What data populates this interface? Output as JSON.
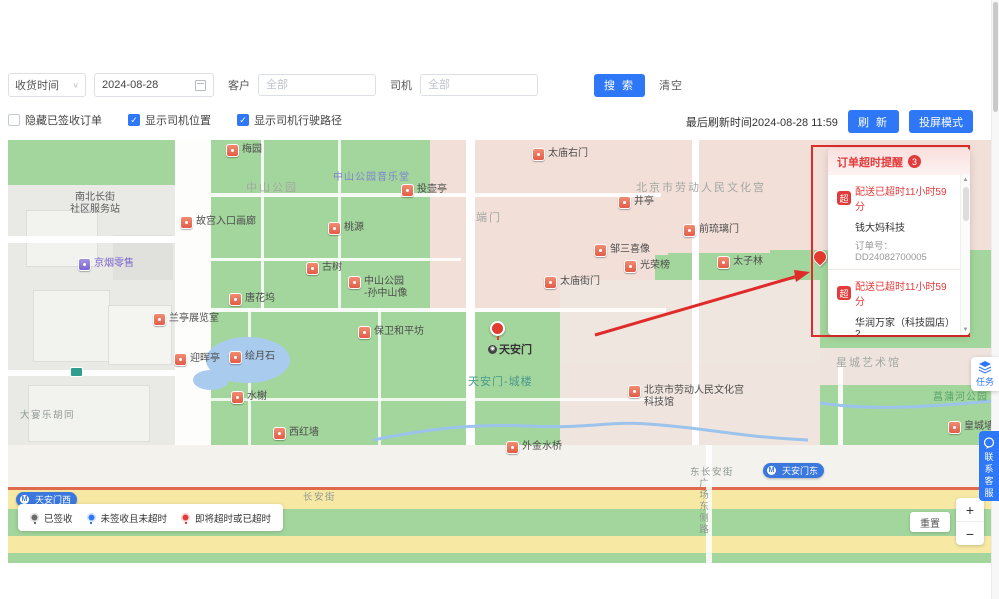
{
  "toolbar": {
    "time_type": "收货时间",
    "date_value": "2024-08-28",
    "customer_label": "客户",
    "customer_placeholder": "全部",
    "driver_label": "司机",
    "driver_placeholder": "全部",
    "search_label": "搜 索",
    "clear_label": "清空"
  },
  "filter_bar": {
    "hide_signed": {
      "label": "隐藏已签收订单",
      "checked": false
    },
    "show_driver_location": {
      "label": "显示司机位置",
      "checked": true
    },
    "show_driver_route": {
      "label": "显示司机行驶路径",
      "checked": true
    },
    "last_refresh": "最后刷新时间2024-08-28 11:59",
    "refresh_label": "刷 新",
    "cast_label": "投屏模式"
  },
  "alert_panel": {
    "title": "订单超时提醒",
    "count": "3",
    "items": [
      {
        "badge": "超",
        "status": "配送已超时11小时59分",
        "customer": "钱大妈科技",
        "order_no": "订单号：DD24082700005"
      },
      {
        "badge": "超",
        "status": "配送已超时11小时59分",
        "customer": "华润万家（科技园店）2",
        "order_no": "订单号：DD24082700003"
      },
      {
        "badge": "超",
        "status": "剩余0分",
        "customer": "华润万家（科技园店）2",
        "order_no": ""
      }
    ]
  },
  "map": {
    "labels": [
      {
        "text": "梅园",
        "x": 218,
        "y": 4,
        "type": "poi"
      },
      {
        "text": "中山公园",
        "x": 238,
        "y": 42,
        "type": "area"
      },
      {
        "lines": [
          "南北长街",
          "社区服务站"
        ],
        "x": 62,
        "y": 52,
        "type": "area-dark"
      },
      {
        "text": "中山公园音乐堂",
        "x": 325,
        "y": 32,
        "type": "area-purple"
      },
      {
        "text": "故宫入口画廊",
        "x": 172,
        "y": 76,
        "type": "poi"
      },
      {
        "text": "桃源",
        "x": 320,
        "y": 82,
        "type": "poi"
      },
      {
        "text": "京烟零售",
        "x": 70,
        "y": 118,
        "type": "poi poi-purple"
      },
      {
        "text": "投壶亭",
        "x": 393,
        "y": 44,
        "type": "poi"
      },
      {
        "text": "端门",
        "x": 468,
        "y": 72,
        "type": "area"
      },
      {
        "text": "太庙右门",
        "x": 524,
        "y": 8,
        "type": "poi"
      },
      {
        "text": "井亭",
        "x": 610,
        "y": 56,
        "type": "poi"
      },
      {
        "text": "北京市劳动人民文化宫",
        "x": 628,
        "y": 42,
        "type": "area"
      },
      {
        "text": "前琉璃门",
        "x": 675,
        "y": 84,
        "type": "poi"
      },
      {
        "text": "邹三喜像",
        "x": 586,
        "y": 104,
        "type": "poi"
      },
      {
        "text": "光荣榜",
        "x": 616,
        "y": 120,
        "type": "poi"
      },
      {
        "text": "太子林",
        "x": 709,
        "y": 116,
        "type": "poi"
      },
      {
        "text": "太庙街门",
        "x": 536,
        "y": 136,
        "type": "poi"
      },
      {
        "text": "古树",
        "x": 298,
        "y": 122,
        "type": "poi"
      },
      {
        "lines": [
          "中山公园",
          "-孙中山像"
        ],
        "x": 340,
        "y": 136,
        "type": "poi"
      },
      {
        "text": "唐花坞",
        "x": 221,
        "y": 153,
        "type": "poi"
      },
      {
        "text": "兰亭展览室",
        "x": 145,
        "y": 173,
        "type": "poi"
      },
      {
        "text": "保卫和平坊",
        "x": 350,
        "y": 186,
        "type": "poi"
      },
      {
        "text": "迎晖亭",
        "x": 166,
        "y": 213,
        "type": "poi"
      },
      {
        "text": "绘月石",
        "x": 221,
        "y": 211,
        "type": "poi"
      },
      {
        "text": "水榭",
        "x": 223,
        "y": 251,
        "type": "poi"
      },
      {
        "text": "西红墙",
        "x": 265,
        "y": 287,
        "type": "poi"
      },
      {
        "text": "大宴乐胡同",
        "x": 12,
        "y": 270,
        "type": "street"
      },
      {
        "text": "",
        "x": 62,
        "y": 227,
        "type": "subway"
      },
      {
        "text": "天安门-城楼",
        "x": 460,
        "y": 236,
        "type": "park-teal"
      },
      {
        "lines": [
          "北京市劳动人民文化宫",
          "科技馆"
        ],
        "x": 620,
        "y": 245,
        "type": "poi"
      },
      {
        "text": "星城艺术馆",
        "x": 828,
        "y": 217,
        "type": "area"
      },
      {
        "text": "菖蒲河公园",
        "x": 925,
        "y": 252,
        "type": "park"
      },
      {
        "text": "皇城墙",
        "x": 940,
        "y": 281,
        "type": "poi"
      },
      {
        "text": "外金水桥",
        "x": 498,
        "y": 301,
        "type": "poi"
      },
      {
        "text": "长安街",
        "x": 295,
        "y": 352,
        "type": "street"
      },
      {
        "text": "东长安街",
        "x": 682,
        "y": 327,
        "type": "street"
      },
      {
        "text": "广场东侧路",
        "x": 688,
        "y": 338,
        "type": "street-v"
      },
      {
        "text": "天安门东",
        "x": 755,
        "y": 323,
        "type": "metro"
      },
      {
        "text": "天安门西",
        "x": 8,
        "y": 352,
        "type": "metro"
      }
    ],
    "tiananmen_label": "天安门",
    "cluster_marker_count": "7",
    "legend": [
      {
        "label": "已签收",
        "color": "#6b6b6b"
      },
      {
        "label": "未签收且未超时",
        "color": "#2e77f6"
      },
      {
        "label": "即将超时或已超时",
        "color": "#e23b3b"
      }
    ],
    "reset_label": "重置",
    "zoom_in_label": "+",
    "zoom_out_label": "−"
  },
  "floats": {
    "task_label": "任务",
    "support_label": "联系客服"
  },
  "colors": {
    "accent_blue": "#2e77f6",
    "alert_red": "#e23b3b",
    "park_green": "#a3d69c",
    "road_yellow": "#f7e9a4",
    "annotation_red": "#e02b2b"
  }
}
